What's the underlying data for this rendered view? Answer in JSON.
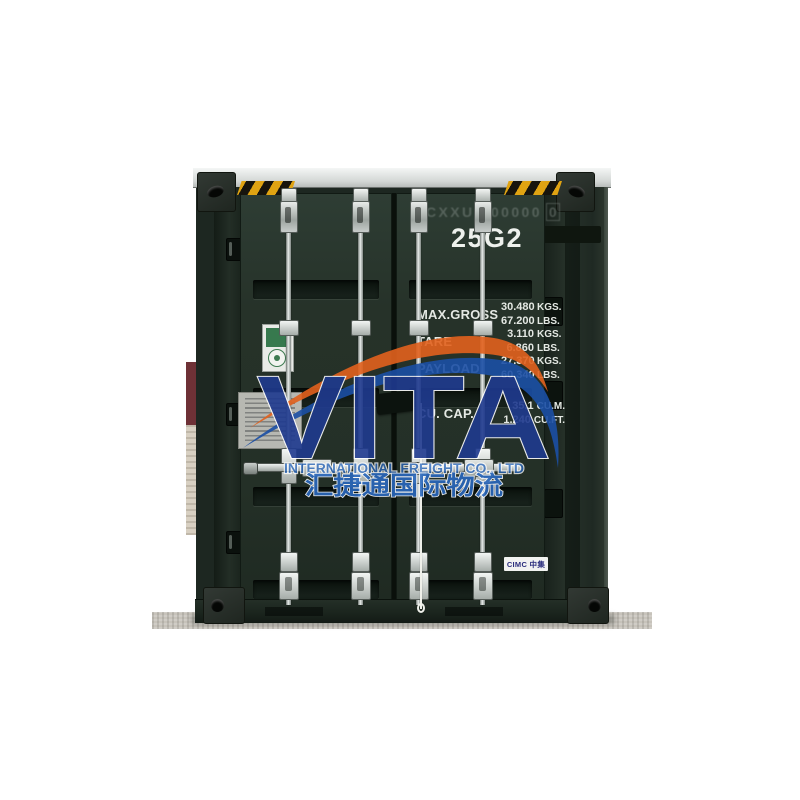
{
  "photo": {
    "watermark": {
      "brand": "VITA",
      "subtitle": "INTERNATIONAL FREIGHT CO., LTD",
      "subtitle_cn": "汇捷通国际物流",
      "brand_color": "#1f3a8f",
      "swoosh_orange": "#e2611d",
      "swoosh_blue": "#1b4fa5",
      "text_blue": "#2a68bd"
    },
    "container": {
      "paint_color": "#243129",
      "hazard_stripe_yellow": "#e0a312",
      "iso_code": "25G2",
      "number_faded": "CXXU 000000",
      "check_digit": "0",
      "specs": {
        "max_gross": {
          "label": "MAX.GROSS",
          "v1": "30.480",
          "u1": "KGS.",
          "v2": "67.200",
          "u2": "LBS."
        },
        "tare": {
          "label": "TARE",
          "v1": "3.110",
          "u1": "KGS.",
          "v2": "6.860",
          "u2": "LBS."
        },
        "payload": {
          "label": "PAYLOAD",
          "v1": "27.370",
          "u1": "KGS.",
          "v2": "60.340",
          "u2": "LBS."
        },
        "capacity": {
          "label": "CU. CAP.",
          "v1": "35.1",
          "u1": "CU.M.",
          "v2": "1.240",
          "u2": "CU.FT."
        }
      },
      "manufacturer_badge": "CIMC 中集"
    }
  }
}
